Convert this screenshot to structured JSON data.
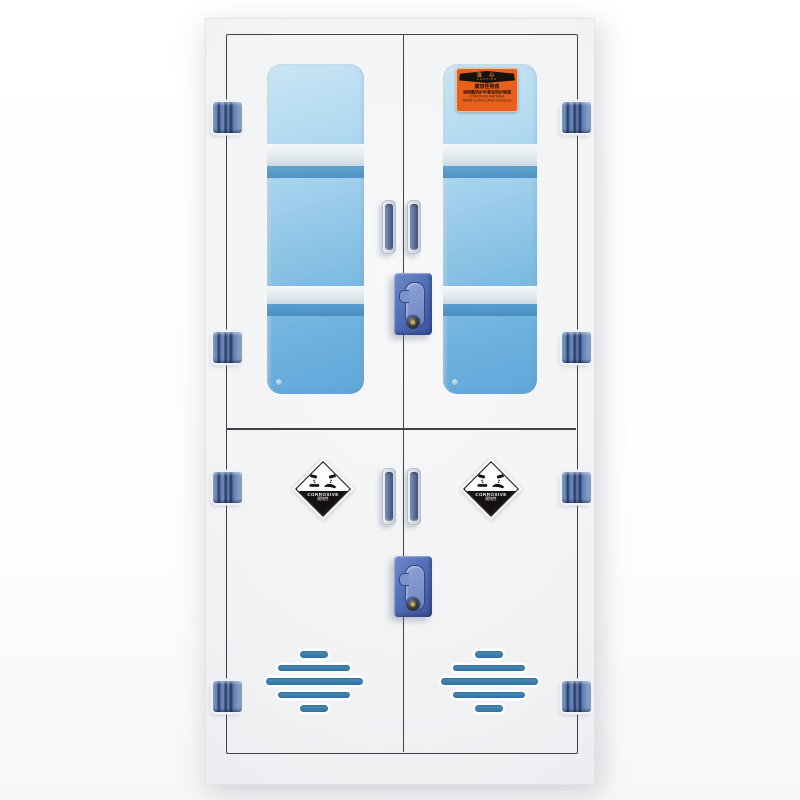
{
  "labels": {
    "caution": {
      "banner_cn": "当 心",
      "banner_en": "CAUTION",
      "line1": "腐蚀性物质",
      "line2": "请佩戴防护手套和防护眼镜",
      "line3": "CORROSIVE MATERIAL",
      "line4": "WEAR GLOVES AND GOGGLES"
    },
    "corrosive": {
      "title": "CORROSIVE",
      "subtitle": "腐蚀性"
    }
  },
  "colors": {
    "door_outline": "#3f4247",
    "cabinet_body": "#f2f3f5",
    "hinge_blue": "#5b7cb0",
    "hinge_dark": "#22345c",
    "handle_outer": "#d6dbe2",
    "handle_inner": "#5f7398",
    "lock_blue": "#5472ba",
    "keyhole_recess": "#7e92cc",
    "glass_light": "#c9e6f5",
    "glass_deep": "#60a8da",
    "shelf_stripe": "#4288bd",
    "vent_blue": "#3377a8",
    "caution_orange": "#e8611c",
    "label_black": "#17120e"
  }
}
